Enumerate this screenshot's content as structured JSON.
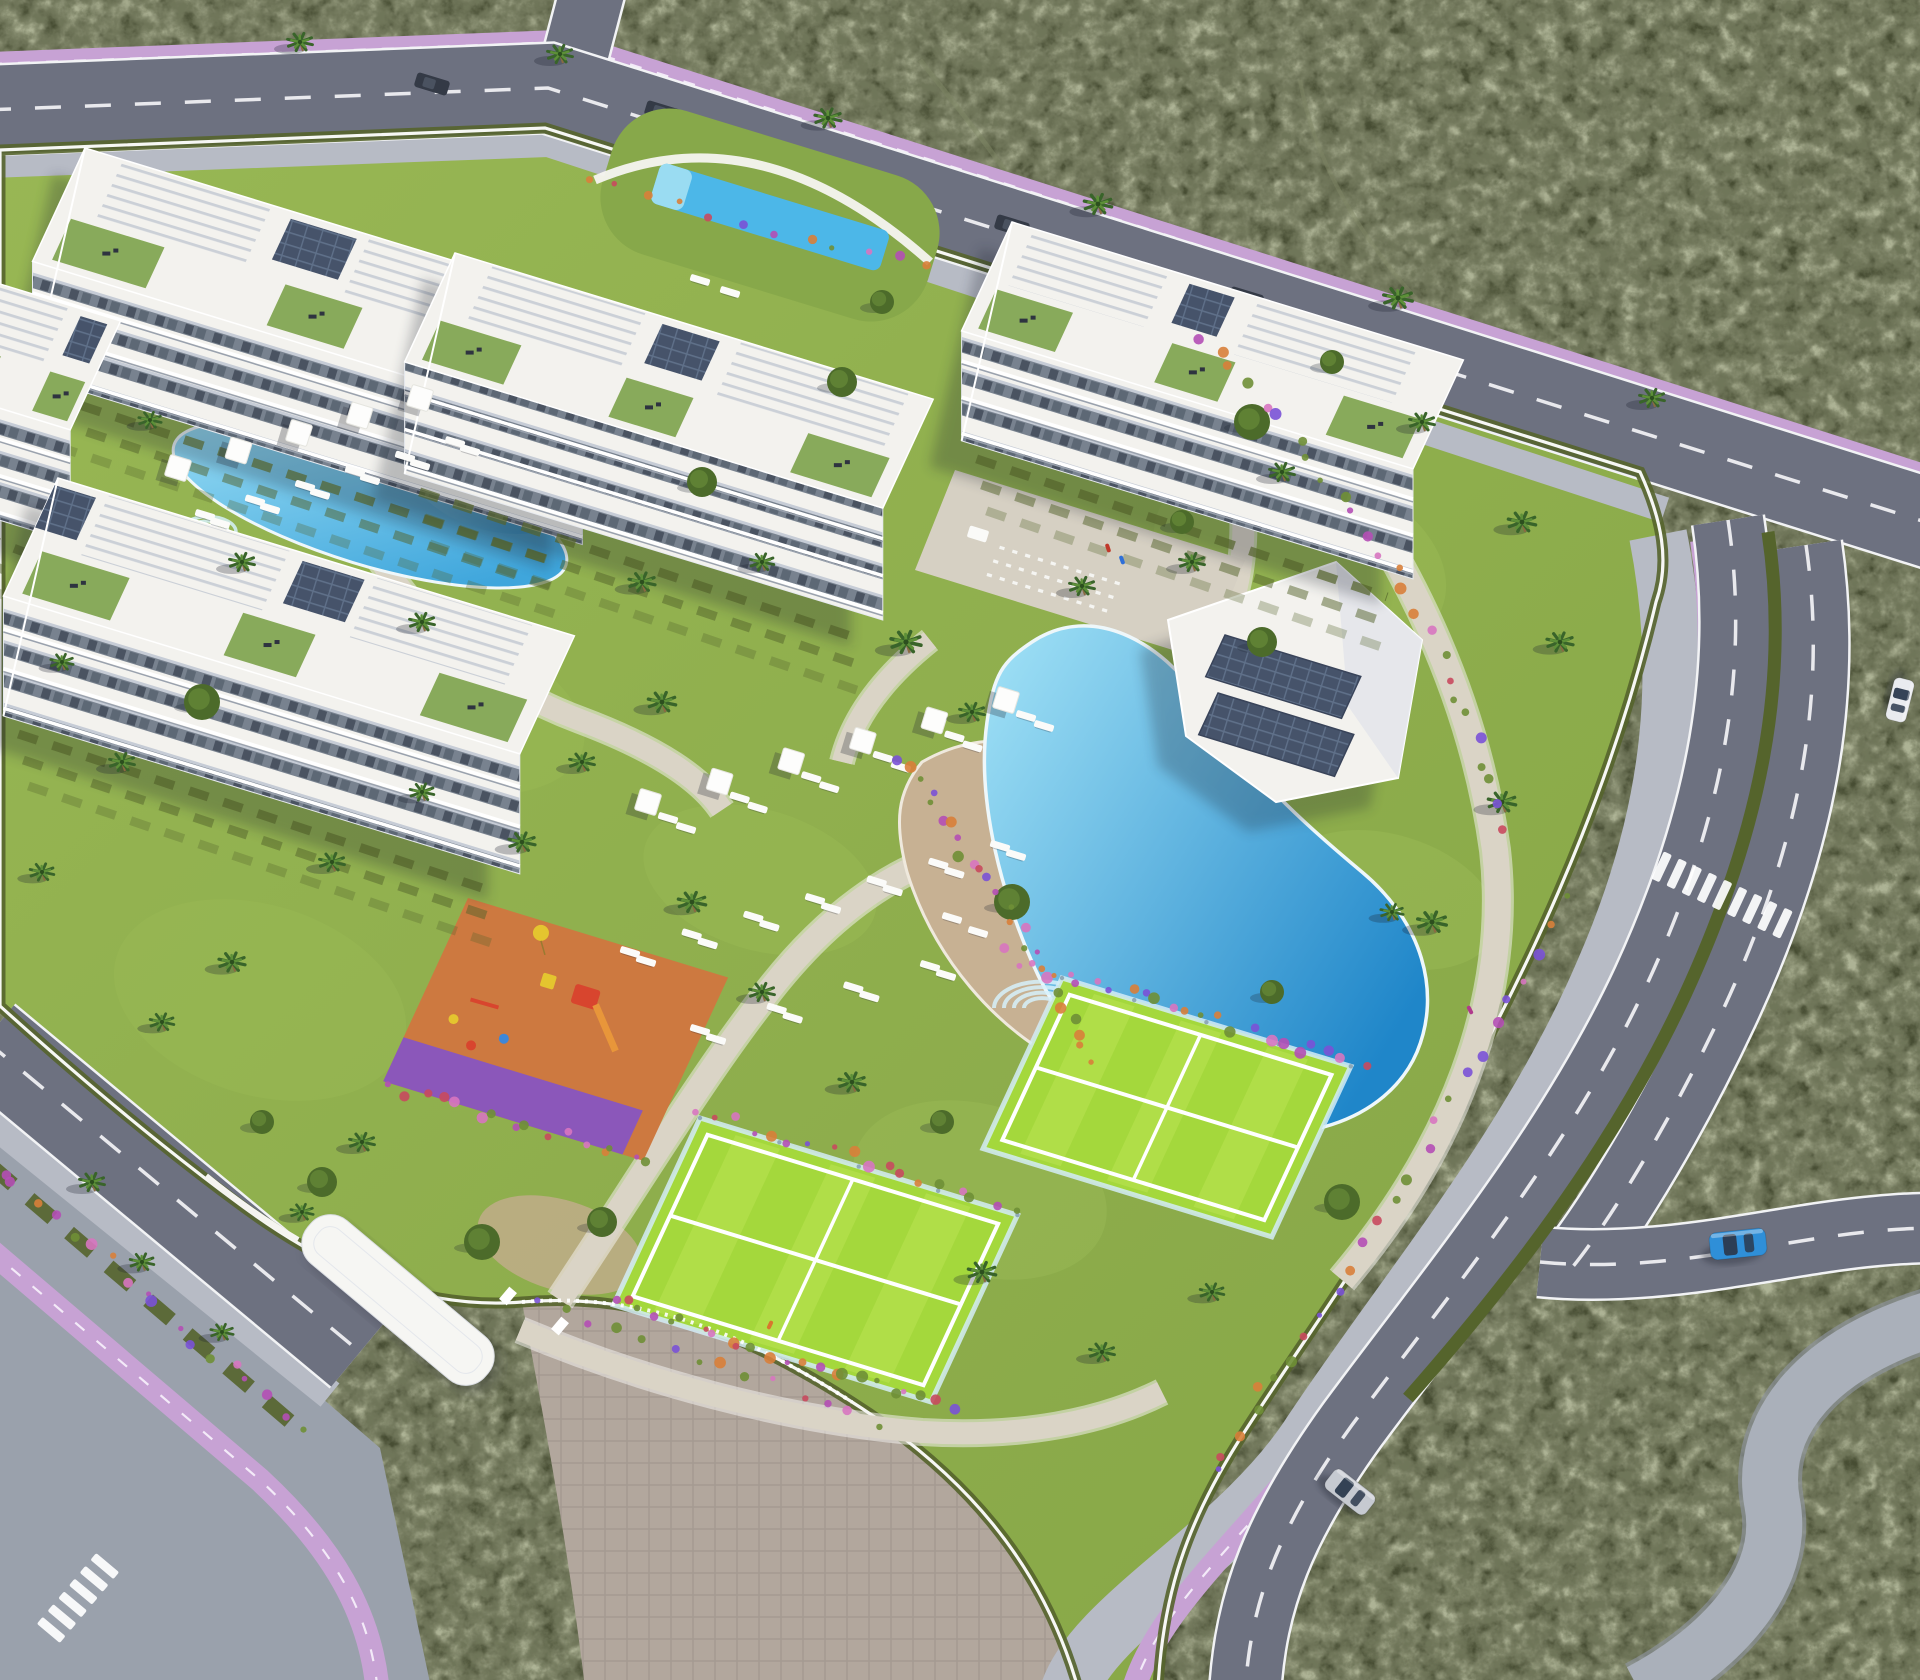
{
  "meta": {
    "title": "Aerial 3D render of a gated seaside apartment complex",
    "type": "architectural-visualization",
    "view": "bird's-eye golden-hour perspective"
  },
  "palette": {
    "scrub": "#474d33",
    "scrub_light": "#6b7348",
    "scrub_dark": "#2b3120",
    "trail": "#808766",
    "grass": "#86a646",
    "grass_light": "#98b754",
    "lawn_pale": "#a6c25f",
    "road": "#6d7180",
    "road_casing": "#f2f3f5",
    "sidewalk": "#b7bbc5",
    "paving": "#9aa1ac",
    "cobble": "#aab0ba",
    "plaza_cobble": "#b2a79d",
    "bike": "#c7a2d4",
    "bike_dash": "#f6eefa",
    "path": "#dad4c6",
    "sand": "#c7b193",
    "dirt": "#c3ad8d",
    "wall_white": "#f5f4f0",
    "pool_deep": "#1f86c9",
    "pool_mid": "#3fa6dc",
    "pool_shallow": "#a3e3f7",
    "pool_edge": "#eef7fa",
    "hedge": "#55642c",
    "hedge_light": "#6d7f34",
    "bush": "#4c6b2a",
    "palm_dark": "#39642a",
    "palm_light": "#5d9038",
    "trunk": "#8a6b42",
    "court": "#a4d83c",
    "court_stripe": "#d2f06a",
    "court_line": "#ffffff",
    "glass": "#d3ecf7",
    "building_white": "#f3f2ee",
    "facade_shade": "#c6ccd6",
    "window_mid": "#78828f",
    "window_dark": "#4a5361",
    "window_dark2": "#5d6875",
    "pergola_slat": "#c9ced6",
    "terrace_green": "#7ca24a",
    "furniture_dark": "#2e3340",
    "solar": "#46536a",
    "solar_line": "#5f7089",
    "playground_orange": "#cd7940",
    "playground_purple": "#7a4fd8",
    "equip_red": "#d8452e",
    "equip_yellow": "#e4c52f",
    "equip_blue": "#3f87d8",
    "equip_orange": "#e8963a",
    "flower_magenta": "#b44fb5",
    "flower_purple": "#7a52d6",
    "flower_pink": "#d776c0",
    "flower_orange": "#d8803a",
    "flower_red": "#c84a5e",
    "leaf": "#6f8f36",
    "car_blue": "#2f8fd8",
    "car_silver": "#c6cad1",
    "car_white": "#e9ebef",
    "car_glass": "#2c3a4e",
    "car_dark": "#343a46",
    "shadow": "#1d222e"
  },
  "scene": {
    "description": "Bird's-eye render of a fenced residential resort: five white apartment blocks with pergola roof terraces, glass balconies and private hedge gardens; a lagoon-style central pool with sand sun-deck, parasols and loungers; a second free-form pool; a reflecting lap pool near the north junction; two fenced padel/tennis courts; a children's playground with orange safety floor; a white clubhouse with rooftop solar panels; an entrance plaza with canopy; perimeter roads with lavender cycle lanes, zebra crossings and hedged medians; dark Mediterranean scrubland all around.",
    "environment": {
      "surroundings": "scrubland",
      "lighting": "late afternoon sun from the east"
    },
    "buildings": [
      {
        "name": "block-a",
        "floors": 4,
        "features": [
          "pergola roof",
          "solar panels",
          "roof terraces"
        ]
      },
      {
        "name": "block-b",
        "floors": 4,
        "features": [
          "pergola roof"
        ]
      },
      {
        "name": "block-c",
        "floors": 4,
        "features": [
          "pergola roof",
          "solar panels"
        ]
      },
      {
        "name": "block-d",
        "floors": 4,
        "features": [
          "pergola roof",
          "solar panels",
          "private gardens"
        ]
      },
      {
        "name": "block-e",
        "floors": 4,
        "features": [
          "pergola roof",
          "roof terraces"
        ]
      },
      {
        "name": "clubhouse",
        "floors": 1,
        "features": [
          "two solar arrays"
        ]
      }
    ],
    "amenities": [
      "lagoon pool",
      "secondary pool",
      "lap pool water feature",
      "padel court upper",
      "padel court lower",
      "playground",
      "sun deck with loungers",
      "event plaza with chair rows",
      "entrance canopy",
      "garden paths"
    ],
    "vehicles": [
      {
        "name": "blue-car",
        "color": "#2f8fd8",
        "location": "east road curve"
      },
      {
        "name": "silver-car",
        "color": "#c6cad1",
        "location": "south-east road"
      },
      {
        "name": "white-car",
        "color": "#e9ebef",
        "location": "east road top"
      },
      {
        "name": "parked-cars",
        "count": 4,
        "color": "#343a46",
        "location": "north road"
      }
    ],
    "infrastructure": {
      "bike_lane_color": "#c7a2d4",
      "crosswalks": 2,
      "roads": [
        "north boulevard",
        "east divided road",
        "south-west access road"
      ]
    },
    "vegetation": {
      "palm_trees": 43,
      "round_trees": 16,
      "flower_borders": 10,
      "hedges": "perimeter + garden partitions"
    }
  }
}
